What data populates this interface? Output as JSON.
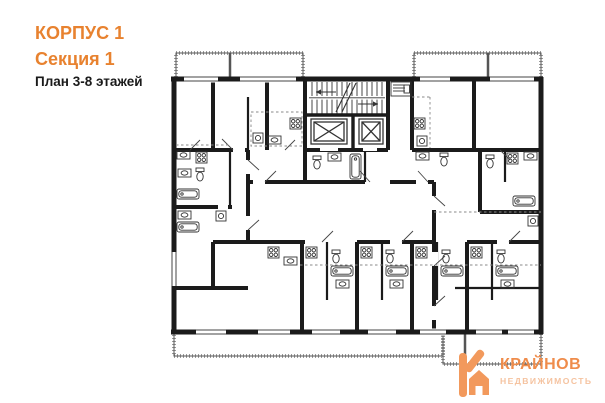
{
  "header": {
    "building": "КОРПУС 1",
    "section": "Секция 1",
    "plan": "План 3-8 этажей"
  },
  "logo": {
    "name": "КРАЙНОВ",
    "subtitle": "НЕДВИЖИМОСТЬ"
  },
  "colors": {
    "accent": "#e8822f",
    "logo_accent": "#f2995c",
    "logo_title": "#ef8c4b",
    "logo_subtitle": "#f5c3a0",
    "wall": "#1b1b1b"
  },
  "floorplan": {
    "icons": [
      "staircase-icon",
      "elevator-icon",
      "stove-icon",
      "sink-icon",
      "toilet-icon",
      "bathtub-icon",
      "washer-icon",
      "balcony-hatch",
      "window",
      "door-leaf"
    ]
  }
}
